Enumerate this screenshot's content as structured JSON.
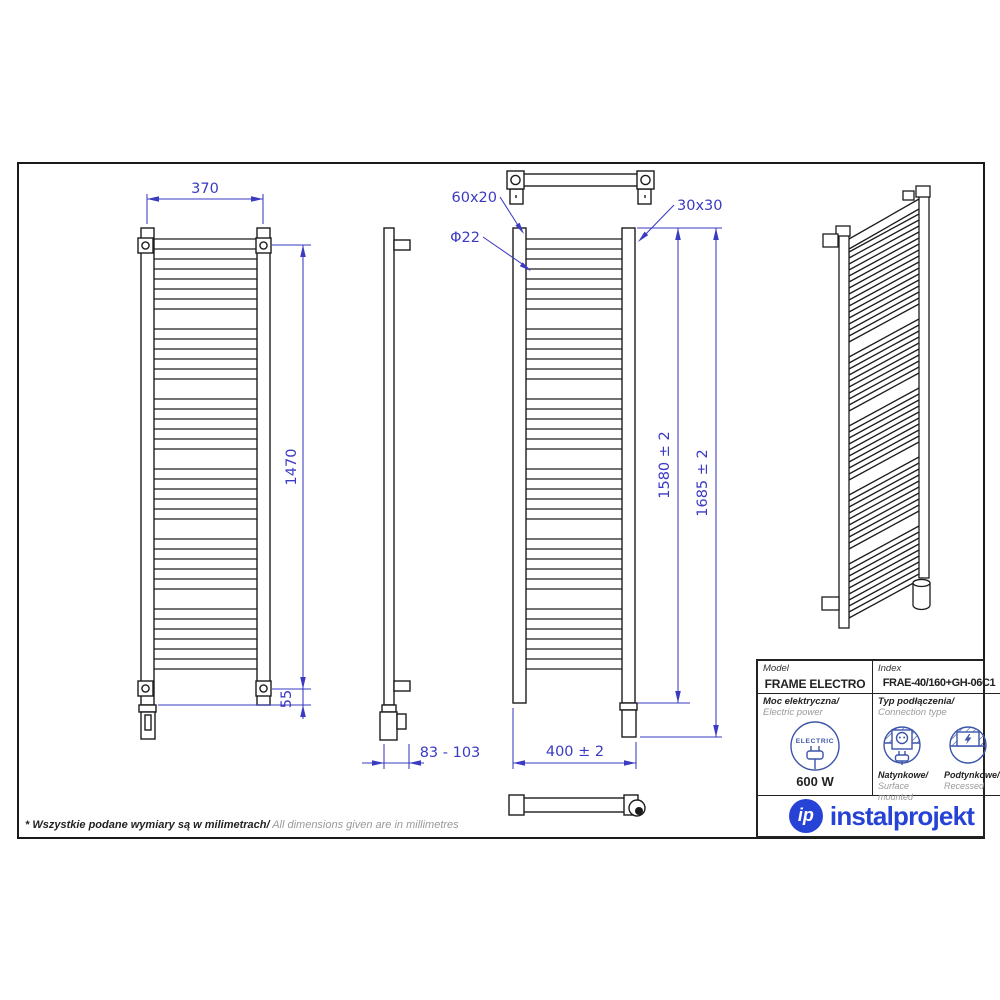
{
  "page": {
    "footnote_pl": "* Wszystkie podane wymiary są w milimetrach/",
    "footnote_en": " All dimensions given are in millimetres"
  },
  "dimensions": {
    "front_width": "370",
    "mount_spacing": "1470",
    "bottom_offset": "55",
    "wall_depth": "83 - 103",
    "rung_profile": "60x20",
    "rung_diameter": "Φ22",
    "collector_profile": "30x30",
    "body_height": "1580 ± 2",
    "total_height": "1685 ± 2",
    "overall_width": "400 ± 2"
  },
  "spec_table": {
    "model_label": "Model",
    "model_value": "FRAME ELECTRO",
    "index_label": "Index",
    "index_value": "FRAE-40/160+GH-06C1",
    "power_label_pl": "Moc elektryczna/",
    "power_label_en": " Electric power",
    "electric_badge": "ELECTRIC",
    "power_value": "600 W",
    "connection_label_pl": "Typ podłączenia/",
    "connection_label_en": "Connection type",
    "surface_pl": "Natynkowe/",
    "surface_en": "Surface mounted",
    "recessed_pl": "Podtynkowe/",
    "recessed_en": "Recessed"
  },
  "brand": {
    "mark": "ip",
    "wordmark": "instalprojekt"
  },
  "colors": {
    "dimension_blue": "#3a3ac2",
    "logo_blue": "#2743d6",
    "icon_blue": "#3c55aa",
    "line_black": "#1c1c1c"
  }
}
